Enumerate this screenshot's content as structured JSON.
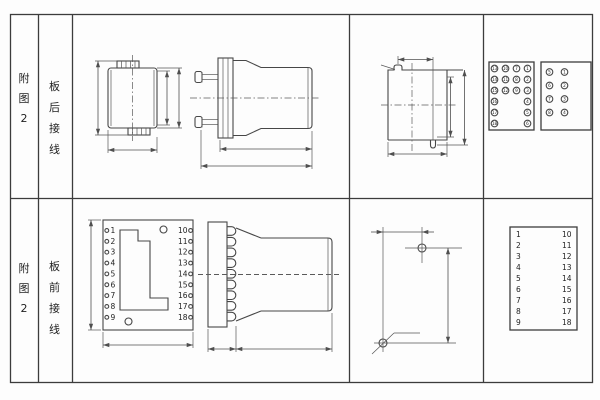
{
  "rows": [
    {
      "side_label": "附图2",
      "model": "JK-1",
      "wiring": "板后接线",
      "rear_view": {
        "overall_height": "106",
        "inner_height": "84",
        "case_height": "94",
        "width": "60"
      },
      "side_view": {
        "body_depth": "124",
        "total_depth": "146"
      },
      "panel_cutout": {
        "corner_label": "2-R2.5",
        "top_width": "48",
        "inner_height": "81",
        "height": "94",
        "width": "56"
      },
      "back_view": {
        "view_label": "背 视",
        "block18": {
          "label": "18点端子",
          "col1": [
            "13",
            "14",
            "15",
            "16",
            "17",
            "18"
          ],
          "col2": [
            "10",
            "11",
            "12"
          ],
          "col3": [
            "7",
            "8",
            "9"
          ],
          "col4": [
            "1",
            "2",
            "3",
            "4",
            "5",
            "6"
          ]
        },
        "block8": {
          "label": "8点端子",
          "col1": [
            "5",
            "6",
            "7",
            "8"
          ],
          "col2": [
            "1",
            "2",
            "3",
            "4"
          ]
        }
      }
    },
    {
      "side_label": "附图2",
      "model": "JK-1Q",
      "wiring": "板前接线",
      "front_view": {
        "height": "118",
        "width": "102",
        "left_terminals": [
          "1",
          "2",
          "3",
          "4",
          "5",
          "6",
          "7",
          "8",
          "9"
        ],
        "right_terminals": [
          "10",
          "11",
          "12",
          "13",
          "14",
          "15",
          "16",
          "17",
          "18"
        ]
      },
      "side_view": {
        "flange_depth": "35",
        "body_depth": "121"
      },
      "drill_plan": {
        "hole_spacing_h": "30±0.1",
        "hole_spacing_v": "100±0.2",
        "holes_label": "2-ø5"
      },
      "front_table": {
        "view_label": "正 视",
        "left": [
          "1",
          "2",
          "3",
          "4",
          "5",
          "6",
          "7",
          "8",
          "9"
        ],
        "right": [
          "10",
          "11",
          "12",
          "13",
          "14",
          "15",
          "16",
          "17",
          "18"
        ]
      }
    }
  ]
}
